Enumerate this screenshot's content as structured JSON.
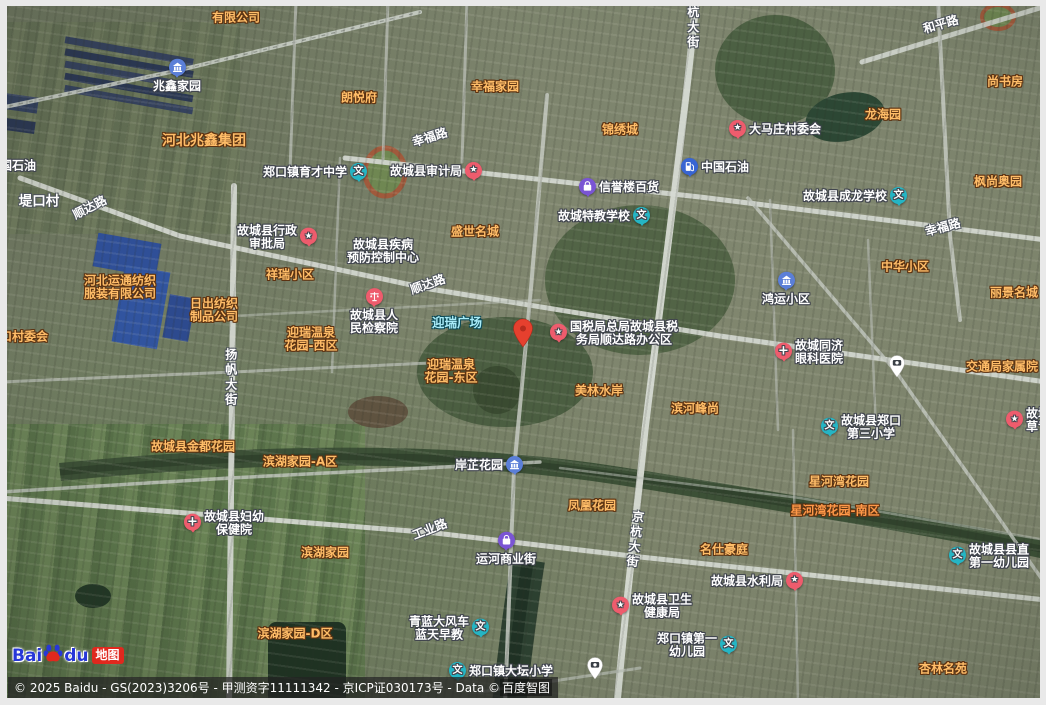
{
  "map": {
    "attribution": {
      "copyright_prefix": "© 2025 Baidu - GS(2023)3206号 - 甲测资字11111342 - 京ICP证030173号 - Data © ",
      "brand": "百度智图"
    },
    "logo": {
      "bai": "Bai",
      "du": "du",
      "badge": "地图"
    },
    "marker": {
      "name": "red-location-marker",
      "x": 523,
      "y": 352
    },
    "traffic_pins": [
      {
        "x": 897,
        "y": 382
      },
      {
        "x": 595,
        "y": 684
      }
    ],
    "icon_glyphs": {
      "school": "文",
      "star": "★",
      "cross": "+"
    },
    "labels": [
      {
        "text": "有限公司",
        "kind": "aoi",
        "x": 236,
        "y": 18
      },
      {
        "text": "河北兆鑫集团",
        "kind": "aoi-big",
        "x": 204,
        "y": 142
      },
      {
        "text": "朗悦府",
        "kind": "aoi",
        "x": 359,
        "y": 98
      },
      {
        "text": "幸福家园",
        "kind": "aoi",
        "x": 495,
        "y": 87
      },
      {
        "text": "锦绣城",
        "kind": "aoi",
        "x": 620,
        "y": 130
      },
      {
        "text": "尚书房",
        "kind": "aoi",
        "x": 1005,
        "y": 82
      },
      {
        "text": "龙海园",
        "kind": "aoi",
        "x": 883,
        "y": 115
      },
      {
        "text": "枫尚奥园",
        "kind": "aoi",
        "x": 998,
        "y": 182
      },
      {
        "text": "中华小区",
        "kind": "aoi",
        "x": 905,
        "y": 267
      },
      {
        "text": "丽景名城",
        "kind": "aoi",
        "x": 1014,
        "y": 293
      },
      {
        "text": "盛世名城",
        "kind": "aoi",
        "x": 475,
        "y": 232
      },
      {
        "text": "祥瑞小区",
        "kind": "aoi",
        "x": 290,
        "y": 275
      },
      {
        "text": "口村委会",
        "kind": "aoi",
        "x": 24,
        "y": 337
      },
      {
        "lines": [
          "河北运通纺织",
          "服装有限公司"
        ],
        "kind": "aoi",
        "x": 120,
        "y": 288
      },
      {
        "lines": [
          "日出纺织",
          "制品公司"
        ],
        "kind": "aoi",
        "x": 214,
        "y": 311
      },
      {
        "lines": [
          "迎瑞温泉",
          "花园-西区"
        ],
        "kind": "aoi",
        "x": 311,
        "y": 340
      },
      {
        "lines": [
          "迎瑞温泉",
          "花园-东区"
        ],
        "kind": "aoi",
        "x": 451,
        "y": 372
      },
      {
        "text": "美林水岸",
        "kind": "aoi",
        "x": 599,
        "y": 391
      },
      {
        "text": "滨河峰尚",
        "kind": "aoi",
        "x": 695,
        "y": 409
      },
      {
        "text": "交通局家属院",
        "kind": "aoi",
        "x": 1002,
        "y": 367
      },
      {
        "text": "星河湾花园",
        "kind": "aoi",
        "x": 839,
        "y": 482
      },
      {
        "text": "星河湾花园-南区",
        "kind": "hot",
        "x": 835,
        "y": 511
      },
      {
        "text": "故城县金都花园",
        "kind": "aoi",
        "x": 193,
        "y": 447
      },
      {
        "text": "滨湖家园-A区",
        "kind": "aoi",
        "x": 300,
        "y": 462
      },
      {
        "text": "滨湖家园",
        "kind": "aoi",
        "x": 325,
        "y": 553
      },
      {
        "text": "滨湖家园-D区",
        "kind": "aoi",
        "x": 295,
        "y": 634
      },
      {
        "text": "凤凰花园",
        "kind": "aoi",
        "x": 592,
        "y": 506
      },
      {
        "text": "名仕豪庭",
        "kind": "aoi",
        "x": 724,
        "y": 550
      },
      {
        "text": "杏林名苑",
        "kind": "aoi",
        "x": 943,
        "y": 669
      },
      {
        "text": "迎瑞广场",
        "kind": "cyan",
        "x": 457,
        "y": 323
      },
      {
        "text": "幸福路",
        "kind": "road",
        "x": 430,
        "y": 138,
        "rot": -17
      },
      {
        "text": "和平路",
        "kind": "road",
        "x": 941,
        "y": 25,
        "rot": -16
      },
      {
        "text": "幸福路",
        "kind": "road",
        "x": 943,
        "y": 228,
        "rot": -15
      },
      {
        "text": "顺达路",
        "kind": "road",
        "x": 428,
        "y": 285,
        "rot": -19
      },
      {
        "text": "顺达路",
        "kind": "road",
        "x": 90,
        "y": 208,
        "rot": -27
      },
      {
        "text": "工业路",
        "kind": "road",
        "x": 430,
        "y": 530,
        "rot": -21
      },
      {
        "text": "杭大街",
        "kind": "roadv",
        "x": 692,
        "y": 28
      },
      {
        "text": "扬帆大街",
        "kind": "roadv",
        "x": 230,
        "y": 378
      },
      {
        "text": "京杭大街",
        "kind": "roadv",
        "x": 634,
        "y": 540,
        "rot": 7
      },
      {
        "text": "堤口村",
        "kind": "village",
        "x": 39,
        "y": 202
      },
      {
        "text": "国石油",
        "kind": "poi",
        "x": 18,
        "y": 166
      },
      {
        "text": "兆鑫家园",
        "kind": "poi",
        "icon": "estate",
        "iconPos": "top",
        "x": 177,
        "y": 76
      },
      {
        "text": "郑口镇育才中学",
        "kind": "poi",
        "icon": "school",
        "iconPos": "right",
        "x": 315,
        "y": 173
      },
      {
        "text": "故城县审计局",
        "kind": "poi",
        "icon": "star",
        "iconPos": "right",
        "x": 436,
        "y": 172
      },
      {
        "text": "信誉楼百货",
        "kind": "poi",
        "icon": "shop",
        "iconPos": "left",
        "x": 619,
        "y": 188
      },
      {
        "text": "中国石油",
        "kind": "poi",
        "icon": "fuel",
        "iconPos": "left",
        "x": 715,
        "y": 168
      },
      {
        "text": "故城特教学校",
        "kind": "poi",
        "icon": "school",
        "iconPos": "right",
        "x": 604,
        "y": 217
      },
      {
        "text": "大马庄村委会",
        "kind": "poi",
        "icon": "star",
        "iconPos": "left",
        "x": 775,
        "y": 130
      },
      {
        "text": "故城县成龙学校",
        "kind": "poi",
        "icon": "school",
        "iconPos": "right",
        "x": 855,
        "y": 197
      },
      {
        "text": "鸿运小区",
        "kind": "poi",
        "icon": "estate",
        "iconPos": "top",
        "x": 786,
        "y": 289
      },
      {
        "lines": [
          "故城县行政",
          "审批局"
        ],
        "kind": "poi",
        "icon": "star",
        "iconPos": "right",
        "x": 277,
        "y": 238
      },
      {
        "lines": [
          "故城县疾病",
          "预防控制中心"
        ],
        "kind": "poi",
        "x": 383,
        "y": 252
      },
      {
        "lines": [
          "故城县人",
          "民检察院"
        ],
        "kind": "poi",
        "icon": "justice",
        "iconPos": "top",
        "x": 374,
        "y": 312
      },
      {
        "lines": [
          "国税局总局故城县税",
          "务局顺达路办公区"
        ],
        "kind": "poi",
        "icon": "star",
        "iconPos": "left",
        "x": 614,
        "y": 334
      },
      {
        "lines": [
          "故城同济",
          "眼科医院"
        ],
        "kind": "poi",
        "icon": "cross",
        "iconPos": "left",
        "x": 809,
        "y": 353
      },
      {
        "lines": [
          "故城县郑口",
          "第三小学"
        ],
        "kind": "poi",
        "icon": "school",
        "iconPos": "left",
        "x": 861,
        "y": 428
      },
      {
        "lines": [
          "故城",
          "草专"
        ],
        "kind": "poi",
        "icon": "star",
        "iconPos": "left",
        "x": 1028,
        "y": 421
      },
      {
        "lines": [
          "故城县妇幼",
          "保健院"
        ],
        "kind": "poi",
        "icon": "cross",
        "iconPos": "left",
        "x": 224,
        "y": 524
      },
      {
        "text": "岸芷花园",
        "kind": "poi",
        "icon": "estate",
        "iconPos": "right",
        "x": 489,
        "y": 466
      },
      {
        "text": "运河商业街",
        "kind": "poi",
        "icon": "shop",
        "iconPos": "top",
        "x": 506,
        "y": 549
      },
      {
        "text": "故城县水利局",
        "kind": "poi",
        "icon": "star",
        "iconPos": "right",
        "x": 757,
        "y": 582
      },
      {
        "lines": [
          "故城县卫生",
          "健康局"
        ],
        "kind": "poi",
        "icon": "star",
        "iconPos": "left",
        "x": 652,
        "y": 607
      },
      {
        "lines": [
          "青蓝大风车",
          "蓝天早教"
        ],
        "kind": "poi",
        "icon": "school",
        "iconPos": "right",
        "x": 449,
        "y": 629
      },
      {
        "lines": [
          "郑口镇第一",
          "幼儿园"
        ],
        "kind": "poi",
        "icon": "school",
        "iconPos": "right",
        "x": 697,
        "y": 646
      },
      {
        "lines": [
          "故城县县直",
          "第一幼儿园"
        ],
        "kind": "poi",
        "icon": "school",
        "iconPos": "left",
        "x": 989,
        "y": 557
      },
      {
        "text": "郑口镇大坛小学",
        "kind": "poi",
        "icon": "school",
        "iconPos": "left",
        "x": 501,
        "y": 672
      }
    ]
  }
}
